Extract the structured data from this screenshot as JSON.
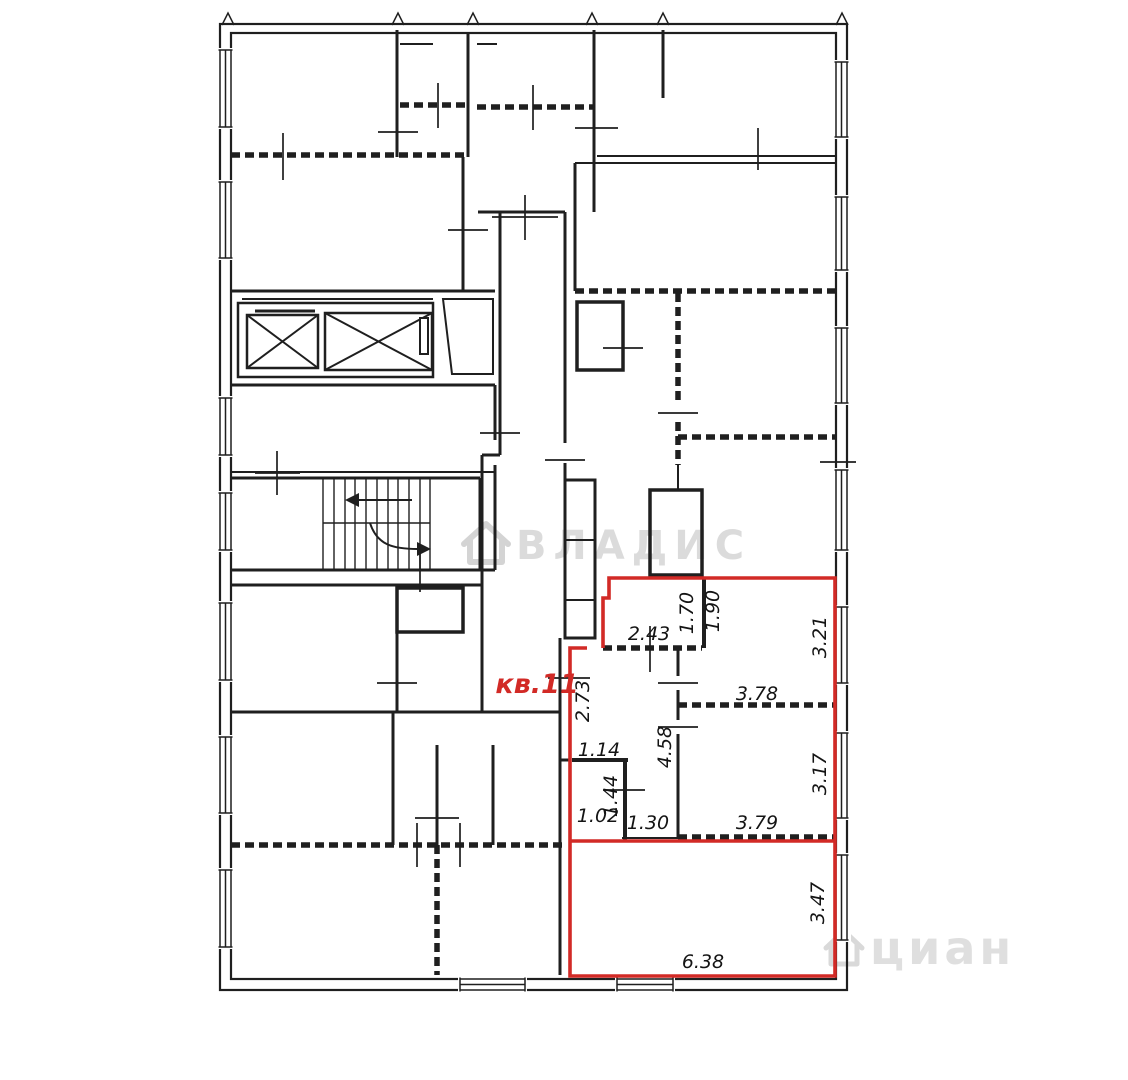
{
  "plan": {
    "apartment_label": "кв.11",
    "accent_color": "#d22a26",
    "dims": {
      "d243": "2.43",
      "d170": "1.70",
      "d190": "1.90",
      "d321": "3.21",
      "d273": "2.73",
      "d378": "3.78",
      "d458": "4.58",
      "d114": "1.14",
      "d317": "3.17",
      "d144": "1.44",
      "d102": "1.02",
      "d130": "1.30",
      "d379": "3.79",
      "d638": "6.38",
      "d347": "3.47"
    }
  },
  "watermarks": {
    "center": "ВЛАДИС",
    "corner": "циан"
  }
}
